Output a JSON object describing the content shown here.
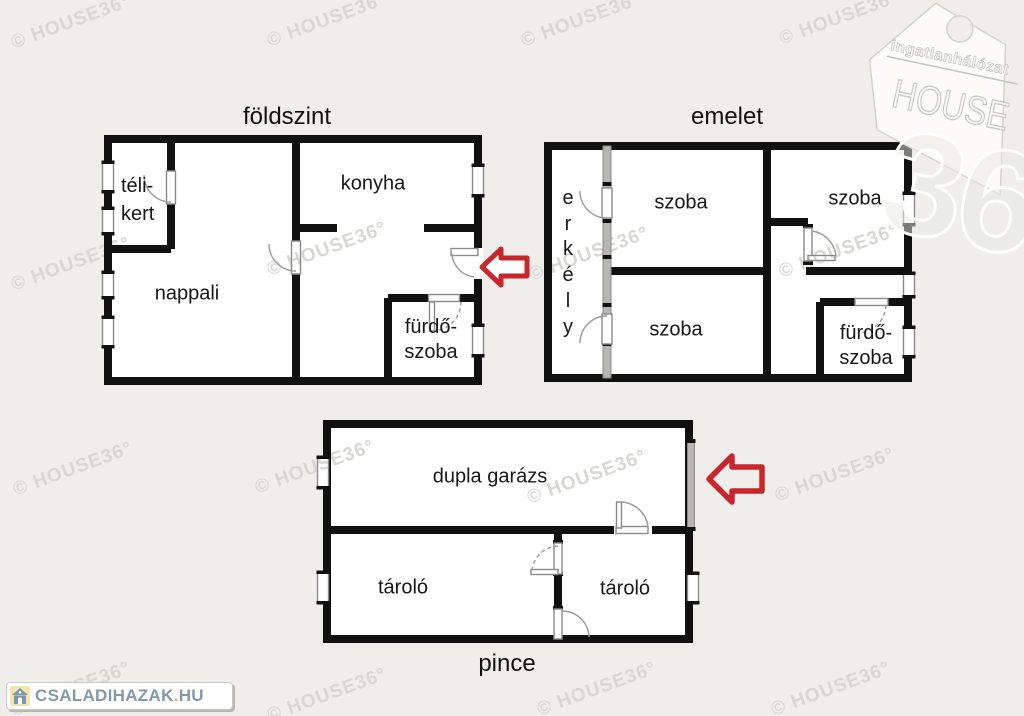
{
  "floors": {
    "ground": {
      "title": "földszint",
      "rooms": {
        "telikert_line1": "téli-",
        "telikert_line2": "kert",
        "konyha": "konyha",
        "nappali": "nappali",
        "furdo_line1": "fürdő-",
        "furdo_line2": "szoba"
      }
    },
    "upper": {
      "title": "emelet",
      "rooms": {
        "erkely_letters": [
          "e",
          "r",
          "k",
          "é",
          "l",
          "y"
        ],
        "szoba_top": "szoba",
        "szoba_right": "szoba",
        "szoba_bottom": "szoba",
        "furdo_line1": "fürdő-",
        "furdo_line2": "szoba"
      }
    },
    "basement": {
      "title": "pince",
      "rooms": {
        "garage": "dupla garázs",
        "storage_left": "tároló",
        "storage_right": "tároló"
      }
    }
  },
  "watermark": {
    "text": "© HOUSE36°"
  },
  "logo_house36": {
    "brand_top": "ingatlanhálózat",
    "brand_main": "HOUSE",
    "brand_number": "36"
  },
  "logo_csaladihazak": {
    "text_main": "CSALADIHAZAK",
    "text_dot": ".",
    "text_tld": "HU"
  },
  "colors": {
    "background": "#efeeea",
    "wall": "#111111",
    "fixture_border": "#8a8a8a",
    "glazing": "#b7b6b2",
    "arrow_red": "#c9252d",
    "watermark": "#d8d7d3",
    "logo_text": "#8099ad",
    "logo_dot": "#e4b44e",
    "logo_icon_bg": "#f2e5ae",
    "logo_icon_fg": "#7d96aa"
  }
}
